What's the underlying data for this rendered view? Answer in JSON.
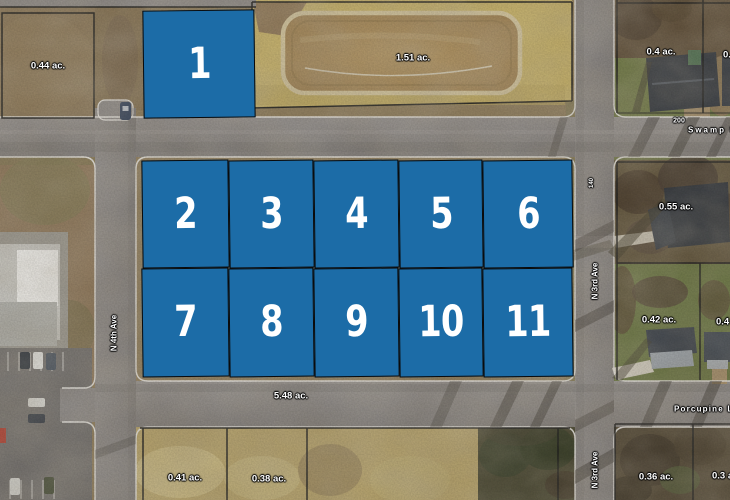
{
  "map": {
    "description": "Aerial plat map with numbered lot overlays",
    "colors": {
      "lot_fill": "#1c6ca7",
      "lot_number": "#ffffff",
      "label_text": "#ffffff",
      "label_halo": "#000000"
    },
    "lots": [
      {
        "number": "1",
        "x": 143,
        "y": 10,
        "w": 112,
        "h": 108
      },
      {
        "number": "2",
        "x": 142,
        "y": 160,
        "w": 87,
        "h": 108
      },
      {
        "number": "3",
        "x": 229,
        "y": 160,
        "w": 85,
        "h": 108
      },
      {
        "number": "4",
        "x": 314,
        "y": 160,
        "w": 85,
        "h": 108
      },
      {
        "number": "5",
        "x": 399,
        "y": 160,
        "w": 84,
        "h": 108
      },
      {
        "number": "6",
        "x": 483,
        "y": 160,
        "w": 90,
        "h": 108
      },
      {
        "number": "7",
        "x": 142,
        "y": 268,
        "w": 87,
        "h": 109
      },
      {
        "number": "8",
        "x": 229,
        "y": 268,
        "w": 85,
        "h": 109
      },
      {
        "number": "9",
        "x": 314,
        "y": 268,
        "w": 85,
        "h": 109
      },
      {
        "number": "10",
        "x": 399,
        "y": 268,
        "w": 84,
        "h": 109
      },
      {
        "number": "11",
        "x": 483,
        "y": 268,
        "w": 90,
        "h": 109
      }
    ],
    "parcel_labels": [
      {
        "text": "0.44 ac.",
        "x": 48,
        "y": 66
      },
      {
        "text": "1.51 ac.",
        "x": 413,
        "y": 58
      },
      {
        "text": "0.4 ac.",
        "x": 661,
        "y": 52
      },
      {
        "text": "0.55 ac.",
        "x": 676,
        "y": 207
      },
      {
        "text": "0.42 ac.",
        "x": 659,
        "y": 320
      },
      {
        "text": "5.48 ac.",
        "x": 291,
        "y": 396
      },
      {
        "text": "0.41 ac.",
        "x": 185,
        "y": 478
      },
      {
        "text": "0.38 ac.",
        "x": 269,
        "y": 479
      },
      {
        "text": "0.36 ac.",
        "x": 656,
        "y": 477
      },
      {
        "text": "0.4 ac.",
        "x": 723,
        "y": 55,
        "anchor": "left"
      },
      {
        "text": "0.4 ac.",
        "x": 716,
        "y": 322,
        "anchor": "left"
      },
      {
        "text": "0.3 ac.",
        "x": 712,
        "y": 476,
        "anchor": "left"
      }
    ],
    "road_labels": [
      {
        "text": "N 4th Ave",
        "x": 114,
        "y": 333,
        "rotate": -90,
        "size": 8
      },
      {
        "text": "N 3rd Ave",
        "x": 595,
        "y": 281,
        "rotate": -90,
        "size": 8
      },
      {
        "text": "N 3rd Ave",
        "x": 595,
        "y": 470,
        "rotate": -90,
        "size": 8
      },
      {
        "text": "200",
        "x": 679,
        "y": 121,
        "size": 7
      },
      {
        "text": "140",
        "x": 592,
        "y": 183,
        "rotate": -90,
        "size": 6
      },
      {
        "text": "Swamp Ln",
        "x": 688,
        "y": 130,
        "anchor": "left",
        "size": 8,
        "spacing": 2
      },
      {
        "text": "Porcupine Ln",
        "x": 674,
        "y": 409,
        "anchor": "left",
        "size": 8,
        "spacing": 1.2
      }
    ]
  }
}
